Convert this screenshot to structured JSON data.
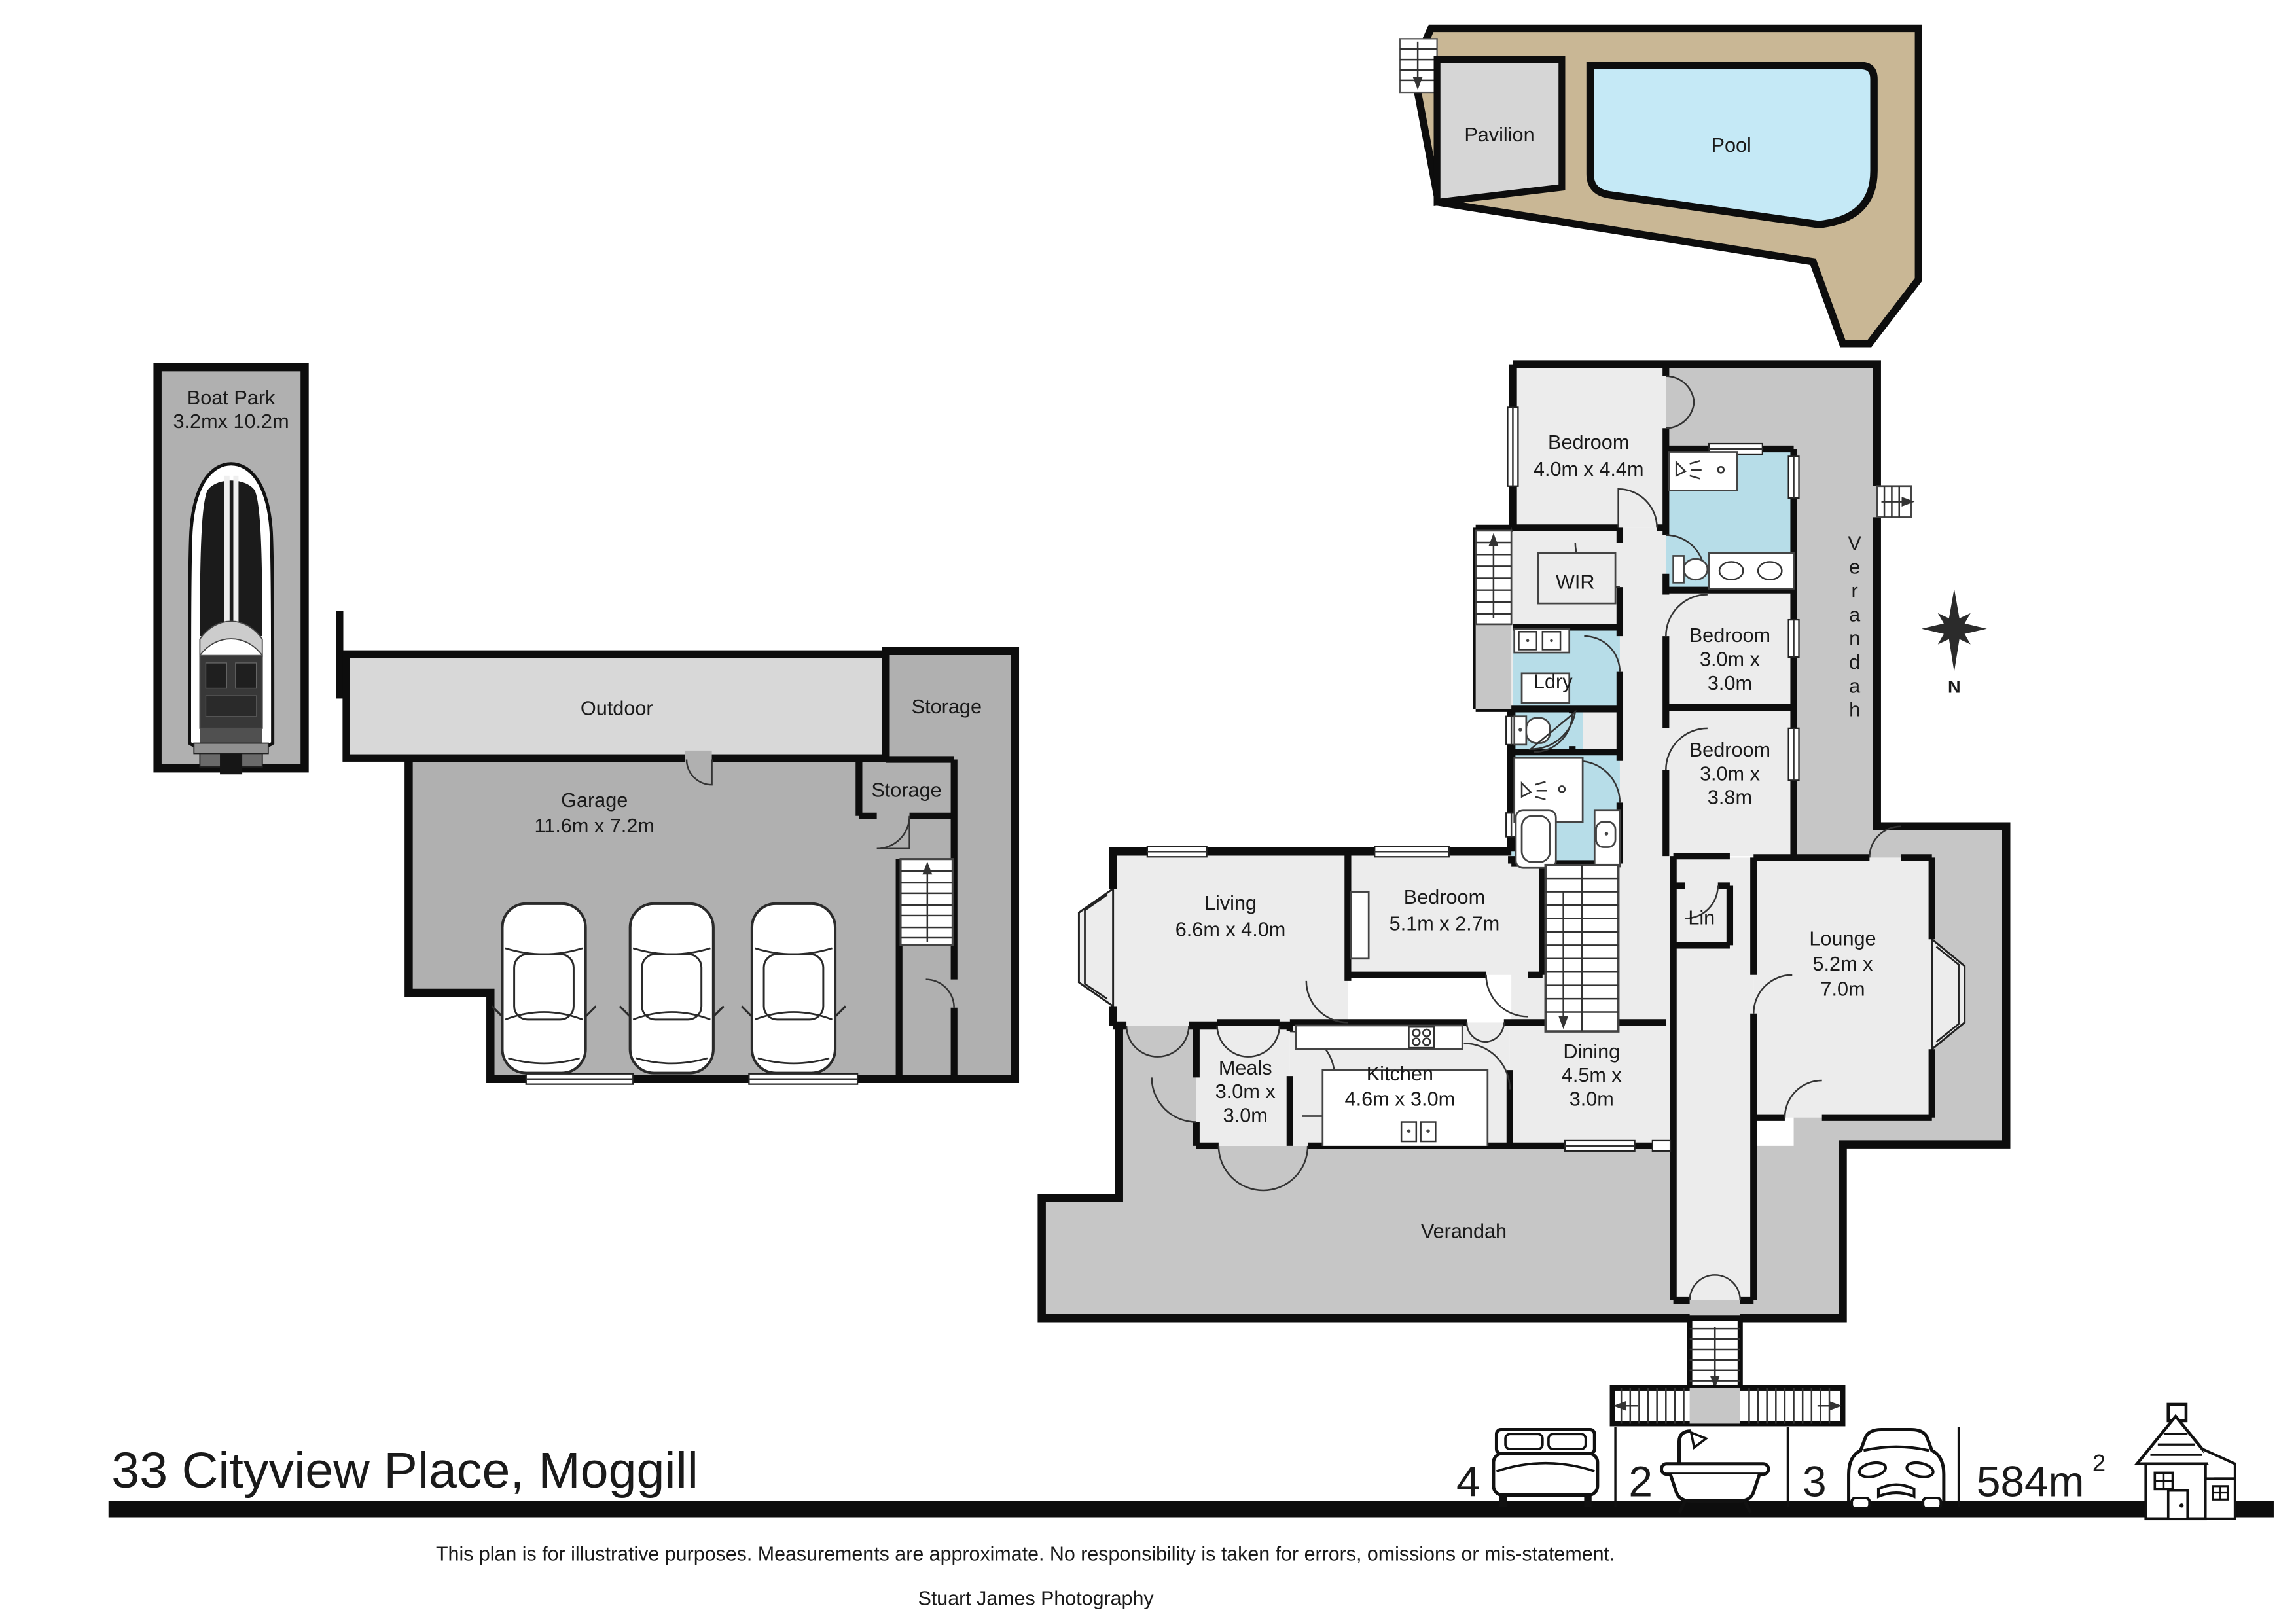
{
  "pool_area": {
    "pavilion_label": "Pavilion",
    "pool_label": "Pool"
  },
  "boat_park": {
    "title": "Boat Park",
    "size": "3.2mx 10.2m"
  },
  "garage_block": {
    "outdoor_label": "Outdoor",
    "storage_upper_label": "Storage",
    "storage_lower_label": "Storage",
    "garage_label": "Garage",
    "garage_size": "11.6m x 7.2m"
  },
  "house": {
    "bedroom_main": {
      "name": "Bedroom",
      "size": "4.0m x 4.4m"
    },
    "wir": {
      "label": "WIR"
    },
    "ldry": {
      "label": "Ldry"
    },
    "bedroom2": {
      "name": "Bedroom",
      "size1": "3.0m x",
      "size2": "3.0m"
    },
    "bedroom3": {
      "name": "Bedroom",
      "size1": "3.0m x",
      "size2": "3.8m"
    },
    "lin": {
      "label": "Lin"
    },
    "lounge": {
      "name": "Lounge",
      "size1": "5.2m x",
      "size2": "7.0m"
    },
    "bedroom4": {
      "name": "Bedroom",
      "size": "5.1m x 2.7m"
    },
    "living": {
      "name": "Living",
      "size": "6.6m x 4.0m"
    },
    "meals": {
      "name": "Meals",
      "size1": "3.0m x",
      "size2": "3.0m"
    },
    "kitchen": {
      "name": "Kitchen",
      "size": "4.6m x 3.0m"
    },
    "dining": {
      "name": "Dining",
      "size1": "4.5m x",
      "size2": "3.0m"
    },
    "verandah_side": {
      "label": "Verandah"
    },
    "verandah_bottom": {
      "label": "Verandah"
    }
  },
  "compass": {
    "north": "N"
  },
  "footer": {
    "address": "33 Cityview Place, Moggill",
    "stats": {
      "beds": "4",
      "baths": "2",
      "cars": "3",
      "area": "584m",
      "area_sup": "2"
    },
    "disclaimer": "This plan is for illustrative purposes. Measurements are approximate. No responsibility is taken for errors, omissions or mis-statement.",
    "credit": "Stuart James Photography"
  },
  "colors": {
    "wall": "#0d0d0d",
    "room": "#ececec",
    "verandah": "#c6c6c6",
    "bathroom": "#b7dde8",
    "garage": "#b0b0b0",
    "outdoor": "#d8d8d8",
    "deck": "#c9b795",
    "pool": "#c5e9f6",
    "pavilion": "#d6d6d6"
  }
}
